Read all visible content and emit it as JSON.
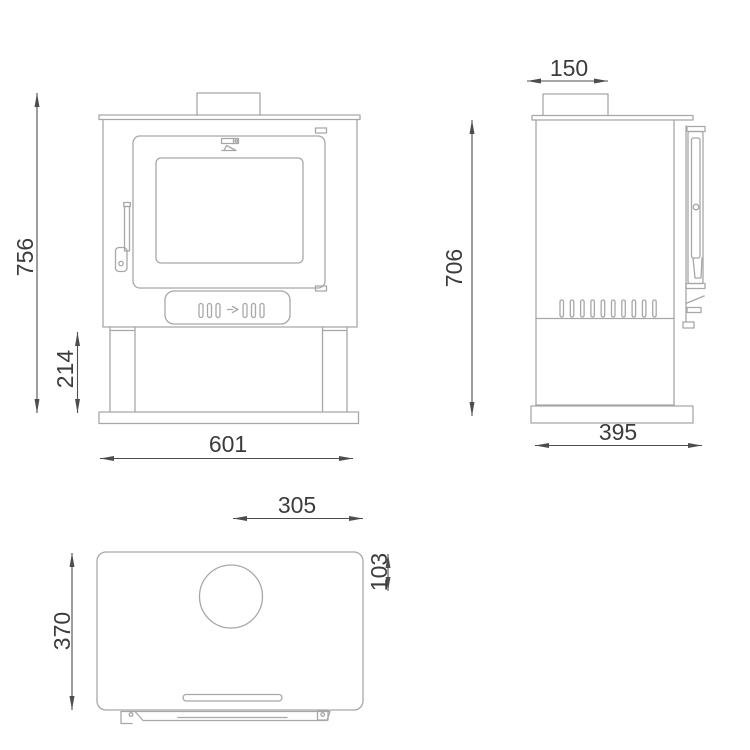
{
  "page": {
    "background": "#ffffff",
    "kind": "technical-dimension-drawing"
  },
  "colors": {
    "outline": "#a7a7a7",
    "dimension_line": "#4d4d4d",
    "dimension_text": "#3c3c3c"
  },
  "views": {
    "front": {
      "label": "front-view",
      "dims": {
        "overall_height": "756",
        "leg_height": "214",
        "overall_width": "601"
      }
    },
    "side": {
      "label": "side-view",
      "dims": {
        "flue_collar_width": "150",
        "body_height": "706",
        "overall_depth": "395"
      }
    },
    "top": {
      "label": "top-view",
      "dims": {
        "flue_centre_to_right_edge": "305",
        "flue_centre_from_back_edge": "103",
        "overall_depth": "370"
      }
    }
  }
}
